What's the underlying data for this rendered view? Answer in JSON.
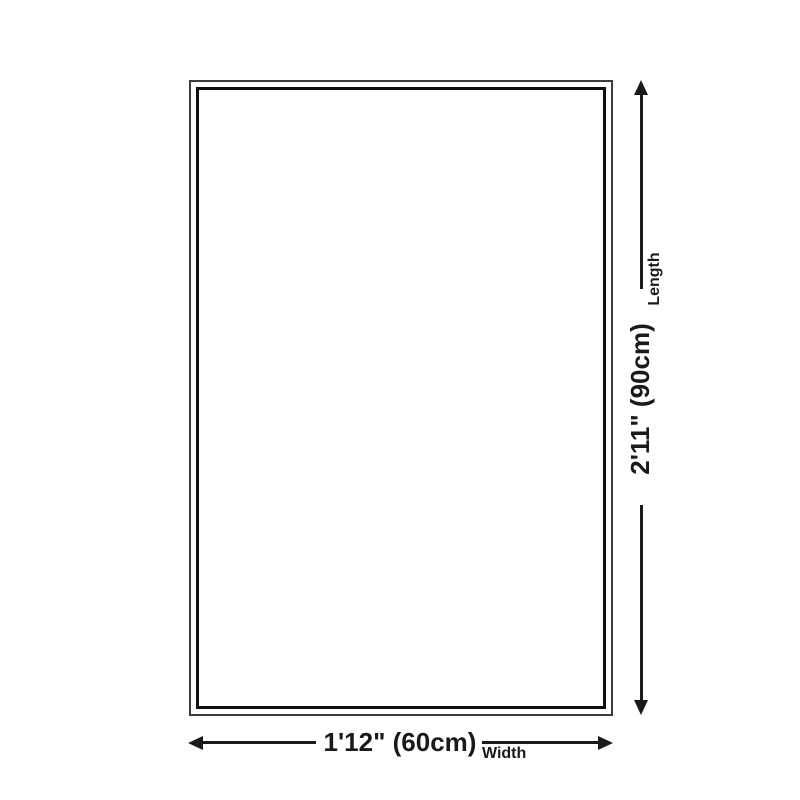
{
  "diagram": {
    "kind": "rug-size-dimension-diagram",
    "width_dimension": {
      "value": "1'12\" (60cm)",
      "label": "Width"
    },
    "length_dimension": {
      "value": "2'11\" (90cm)",
      "label": "Length"
    },
    "icons": {
      "length_arrow": "double-headed-arrow-vertical",
      "width_arrow": "double-headed-arrow-horizontal"
    },
    "colors": {
      "background": "#ffffff",
      "line": "#1a1a1a",
      "text": "#1a1a1a",
      "rug_outer_border": "#3d3d3d",
      "rug_inner_border": "#101010"
    }
  }
}
